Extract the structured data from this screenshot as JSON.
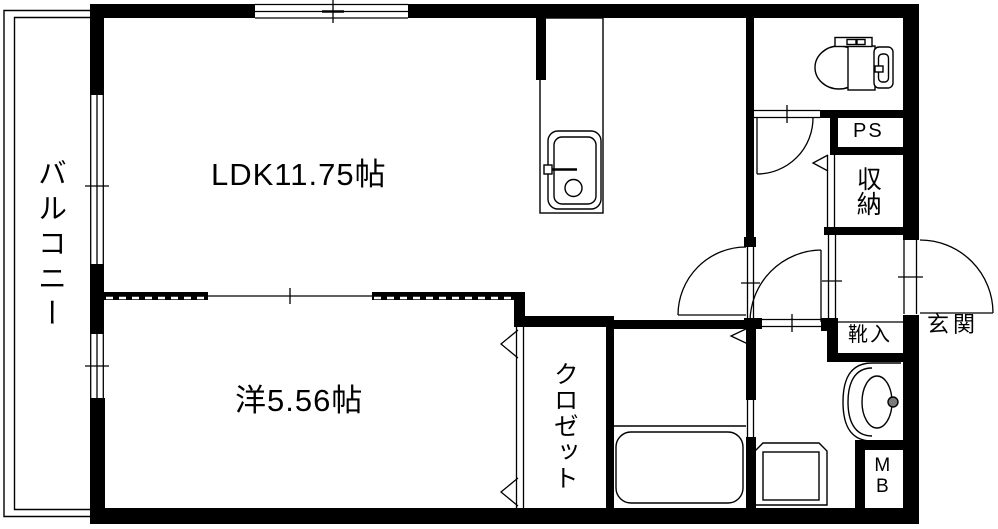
{
  "floor_plan": {
    "balcony_label": "バルコニー",
    "ldk_label": "LDK11.75帖",
    "bedroom_label": "洋5.56帖",
    "closet_label": "クロゼット",
    "storage_label": "収納",
    "pipe_space_label": "PS",
    "shoe_cabinet_label": "靴入",
    "entrance_label": "玄関",
    "meter_box_label": "MB"
  },
  "colors": {
    "line": "#000000",
    "background": "#ffffff",
    "faucet_knob": "#7a7a7a"
  }
}
